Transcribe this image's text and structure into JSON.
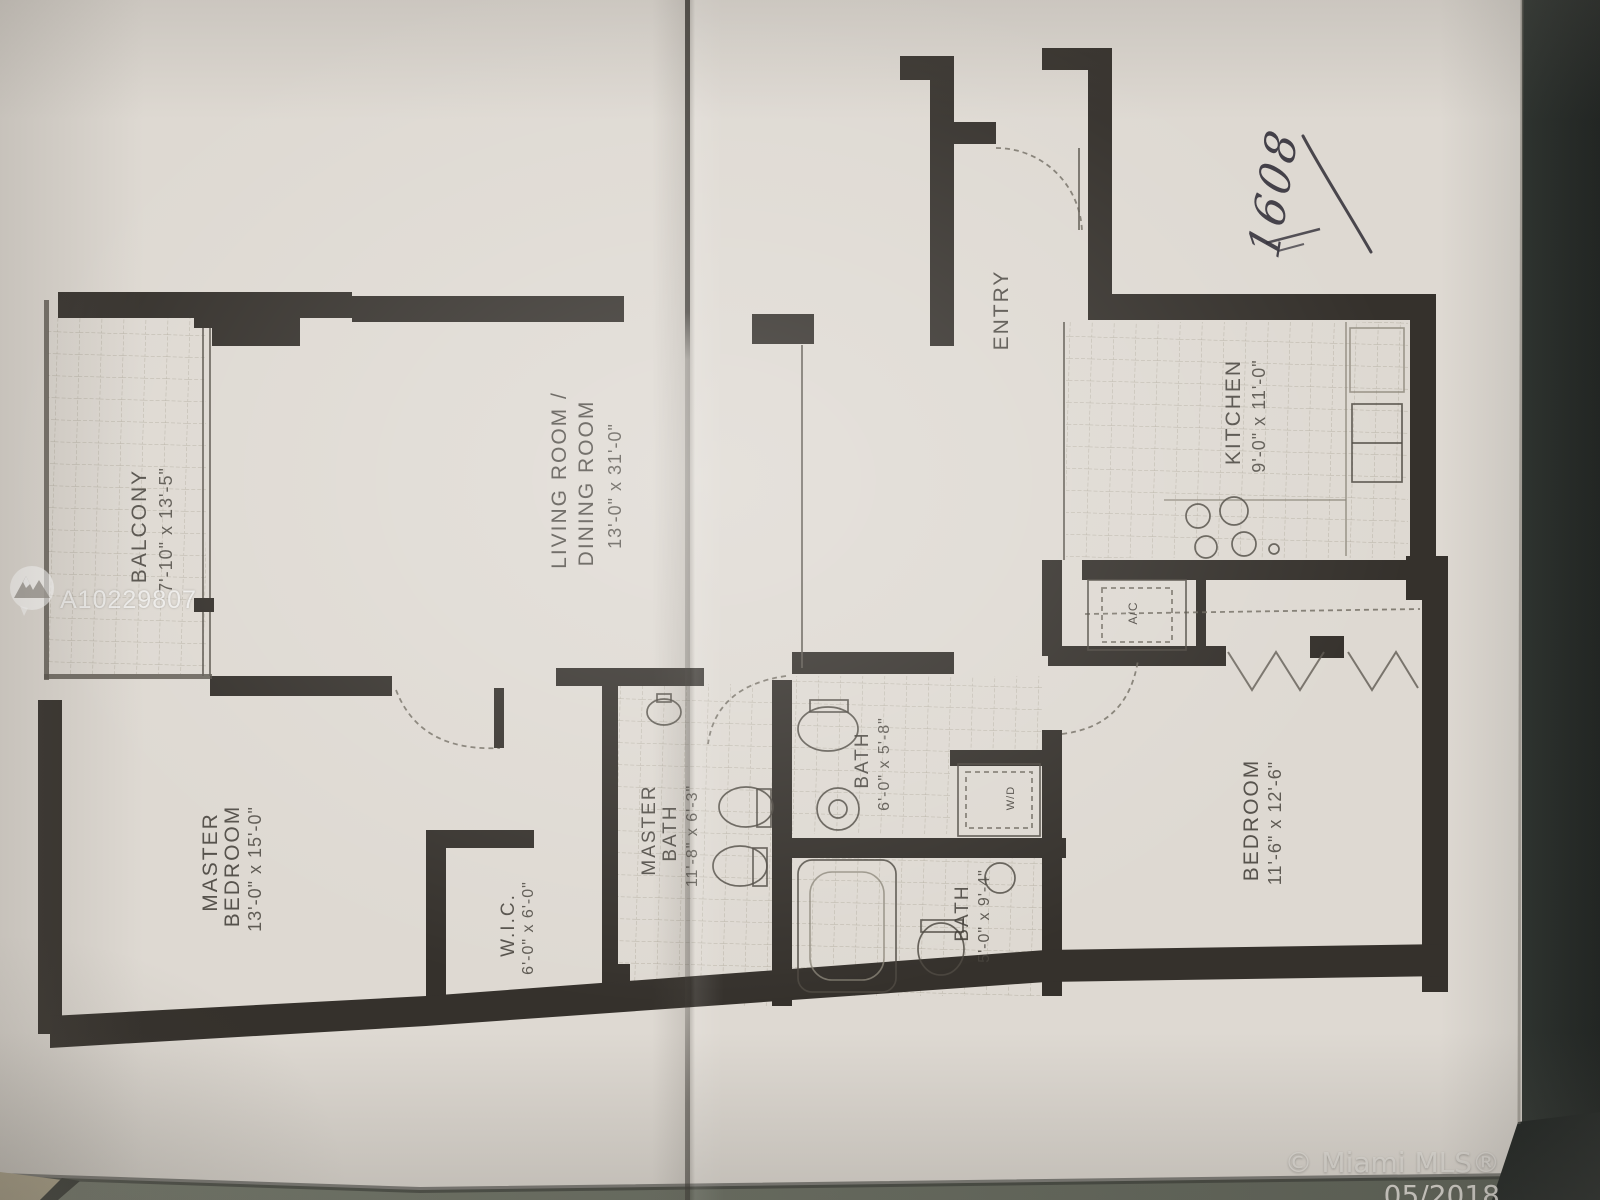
{
  "photo": {
    "listing_watermark": {
      "id_text": "A10229807",
      "logo": "miami-mls-mountain-logo"
    },
    "footer_watermark": {
      "text": "© Miami MLS® 05/2018"
    },
    "handwritten_note": {
      "text": "1608"
    },
    "colors": {
      "paper": "#ded9d2",
      "ink": "#35312c",
      "desk_background": "#1c2220",
      "table_edge": "#6e7266",
      "carpet": "#b5aa8d"
    }
  },
  "floor_plan": {
    "rooms": [
      {
        "id": "balcony",
        "name": "BALCONY",
        "name2": "",
        "dims": "7'-10\" x 13'-5\""
      },
      {
        "id": "living_dining",
        "name": "LIVING ROOM /",
        "name2": "DINING ROOM",
        "dims": "13'-0\" x 31'-0\""
      },
      {
        "id": "entry",
        "name": "ENTRY",
        "name2": "",
        "dims": ""
      },
      {
        "id": "kitchen",
        "name": "KITCHEN",
        "name2": "",
        "dims": "9'-0\" x 11'-0\""
      },
      {
        "id": "master_bedroom",
        "name": "MASTER",
        "name2": "BEDROOM",
        "dims": "13'-0\" x 15'-0\""
      },
      {
        "id": "wic",
        "name": "W.I.C.",
        "name2": "",
        "dims": "6'-0\" x 6'-0\""
      },
      {
        "id": "master_bath",
        "name": "MASTER",
        "name2": "BATH",
        "dims": "11'-8\" x 6'-3\""
      },
      {
        "id": "bath_1",
        "name": "BATH",
        "name2": "",
        "dims": "6'-0\" x 5'-8\""
      },
      {
        "id": "bath_2",
        "name": "BATH",
        "name2": "",
        "dims": "5'-0\" x 9'-4\""
      },
      {
        "id": "bedroom",
        "name": "BEDROOM",
        "name2": "",
        "dims": "11'-6\" x 12'-6\""
      }
    ],
    "closets": [
      {
        "id": "ac_closet",
        "label": "A/C"
      },
      {
        "id": "wd_closet",
        "label": "W/D"
      }
    ]
  }
}
